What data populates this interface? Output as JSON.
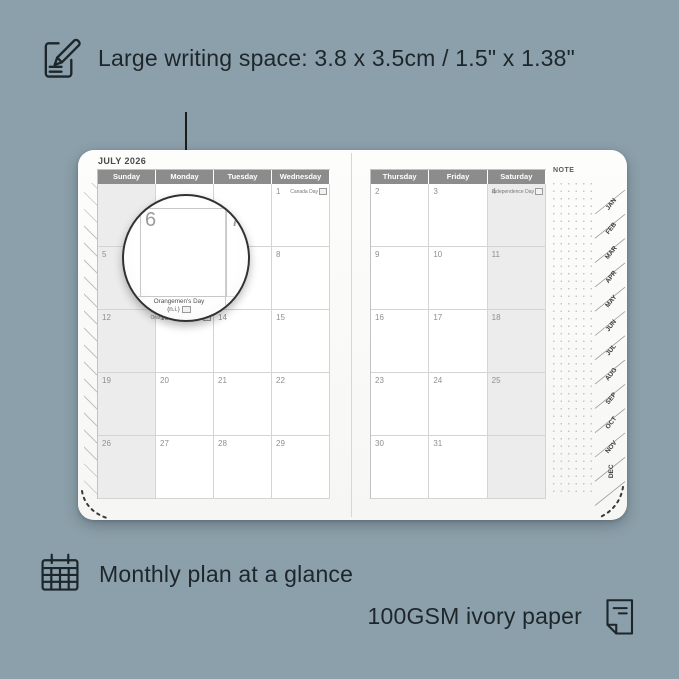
{
  "colors": {
    "background": "#8CA0AB",
    "ink": "#1D262B",
    "page": "#FCFCFB",
    "header_bg": "#8A8A8A",
    "shaded_cell": "#ECECEC",
    "grid_line": "#D4D4D4",
    "day_number": "#8F8F8F"
  },
  "annotations": {
    "top": "Large writing space: 3.8 x 3.5cm / 1.5\" x 1.38\"",
    "bottom_left": "Monthly plan at a glance",
    "bottom_right": "100GSM ivory paper"
  },
  "planner": {
    "month_title": "JULY 2026",
    "note_label": "NOTE",
    "left_page": {
      "headers": [
        "Sunday",
        "Monday",
        "Tuesday",
        "Wednesday"
      ],
      "shaded_column": 0,
      "rows": [
        [
          {
            "day": ""
          },
          {
            "day": ""
          },
          {
            "day": ""
          },
          {
            "day": "1",
            "holiday": "Canada Day"
          }
        ],
        [
          {
            "day": "5"
          },
          {
            "day": "6"
          },
          {
            "day": "7"
          },
          {
            "day": "8"
          }
        ],
        [
          {
            "day": "12"
          },
          {
            "day": "13",
            "holiday": "Orangemen's Day (n.i.)"
          },
          {
            "day": "14"
          },
          {
            "day": "15"
          }
        ],
        [
          {
            "day": "19"
          },
          {
            "day": "20"
          },
          {
            "day": "21"
          },
          {
            "day": "22"
          }
        ],
        [
          {
            "day": "26"
          },
          {
            "day": "27"
          },
          {
            "day": "28"
          },
          {
            "day": "29"
          }
        ]
      ]
    },
    "right_page": {
      "headers": [
        "Thursday",
        "Friday",
        "Saturday"
      ],
      "shaded_column": 2,
      "rows": [
        [
          {
            "day": "2"
          },
          {
            "day": "3"
          },
          {
            "day": "4",
            "holiday": "Independence Day"
          }
        ],
        [
          {
            "day": "9"
          },
          {
            "day": "10"
          },
          {
            "day": "11"
          }
        ],
        [
          {
            "day": "16"
          },
          {
            "day": "17"
          },
          {
            "day": "18"
          }
        ],
        [
          {
            "day": "23"
          },
          {
            "day": "24"
          },
          {
            "day": "25"
          }
        ],
        [
          {
            "day": "30"
          },
          {
            "day": "31"
          },
          {
            "day": ""
          }
        ]
      ]
    },
    "month_tabs": [
      "JAN",
      "FEB",
      "MAR",
      "APR",
      "MAY",
      "JUN",
      "JUL",
      "AUG",
      "SEP",
      "OCT",
      "NOV",
      "DEC"
    ]
  },
  "magnifier": {
    "zoom_day": "6",
    "adjacent_day": "7",
    "partial_day": "13",
    "holiday_line1": "Orangemen's Day",
    "holiday_line2": "(n.i.)"
  }
}
